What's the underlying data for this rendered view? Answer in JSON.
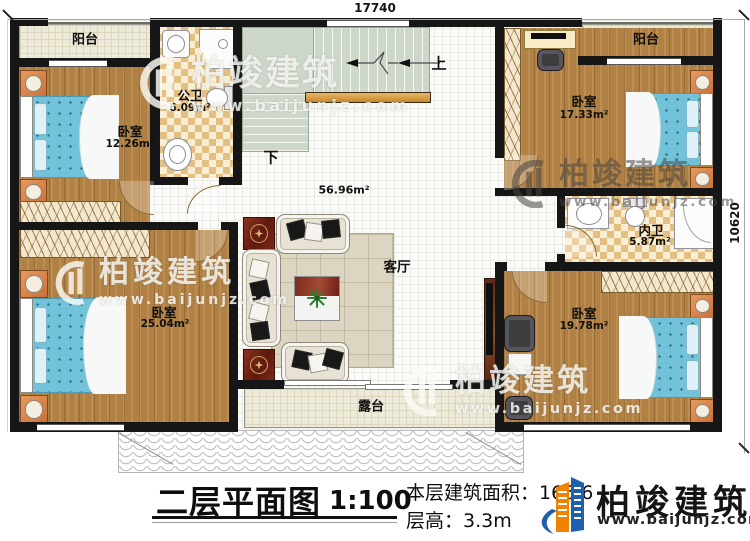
{
  "dimensions": {
    "top_width": "17740",
    "right_height": "10620"
  },
  "rooms": {
    "balcony_left": {
      "name": "阳台"
    },
    "balcony_right": {
      "name": "阳台"
    },
    "public_bath": {
      "name": "公卫",
      "area": "6.09m²"
    },
    "bedroom_top_left": {
      "name": "卧室",
      "area": "12.26m²"
    },
    "bedroom_top_right": {
      "name": "卧室",
      "area": "17.33m²"
    },
    "inner_bath": {
      "name": "内卫",
      "area": "5.87m²"
    },
    "bedroom_bottom_left": {
      "name": "卧室",
      "area": "25.04m²"
    },
    "bedroom_bottom_right": {
      "name": "卧室",
      "area": "19.78m²"
    },
    "living_room": {
      "name": "客厅",
      "area": "56.96m²"
    },
    "terrace": {
      "name": "露台"
    }
  },
  "stairs": {
    "up": "上",
    "down": "下"
  },
  "title_block": {
    "plan_title": "二层平面图",
    "scale": "1:100",
    "floor_area": "本层建筑面积：166.6",
    "floor_height": "层高：3.3m"
  },
  "brand": {
    "name": "柏竣建筑",
    "website": "www.baijunjz.com"
  },
  "colors": {
    "logo_blue": "#1e5fb0",
    "logo_orange": "#ef8200",
    "wall": "#161616",
    "wood": "#b08044",
    "bed_blue": "#72c2da",
    "railing_orange": "#d79b3e"
  }
}
